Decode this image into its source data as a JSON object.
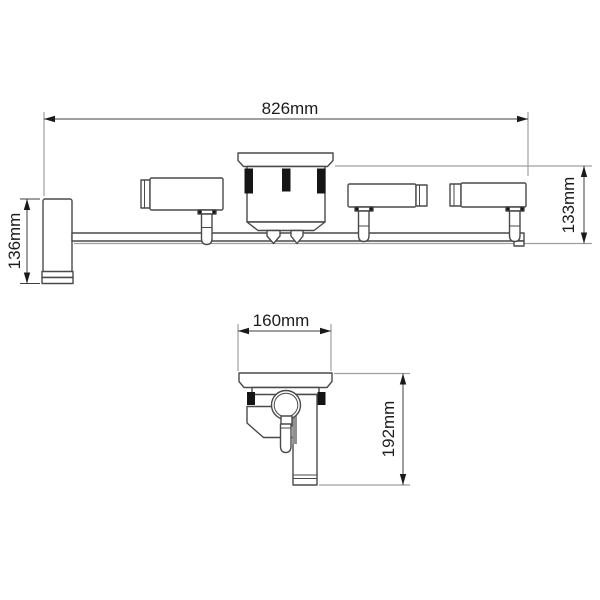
{
  "front_view": {
    "overall_width_label": "826mm",
    "left_height_label": "136mm",
    "right_height_label": "133mm"
  },
  "side_view": {
    "width_label": "160mm",
    "height_label": "192mm"
  },
  "colors": {
    "background": "#ffffff",
    "outline": "#4a4a4a",
    "dimension_line": "#3f3f3f",
    "extension_line": "#9f9f9f",
    "clip_fill": "#151515",
    "text": "#1c1c1c"
  }
}
